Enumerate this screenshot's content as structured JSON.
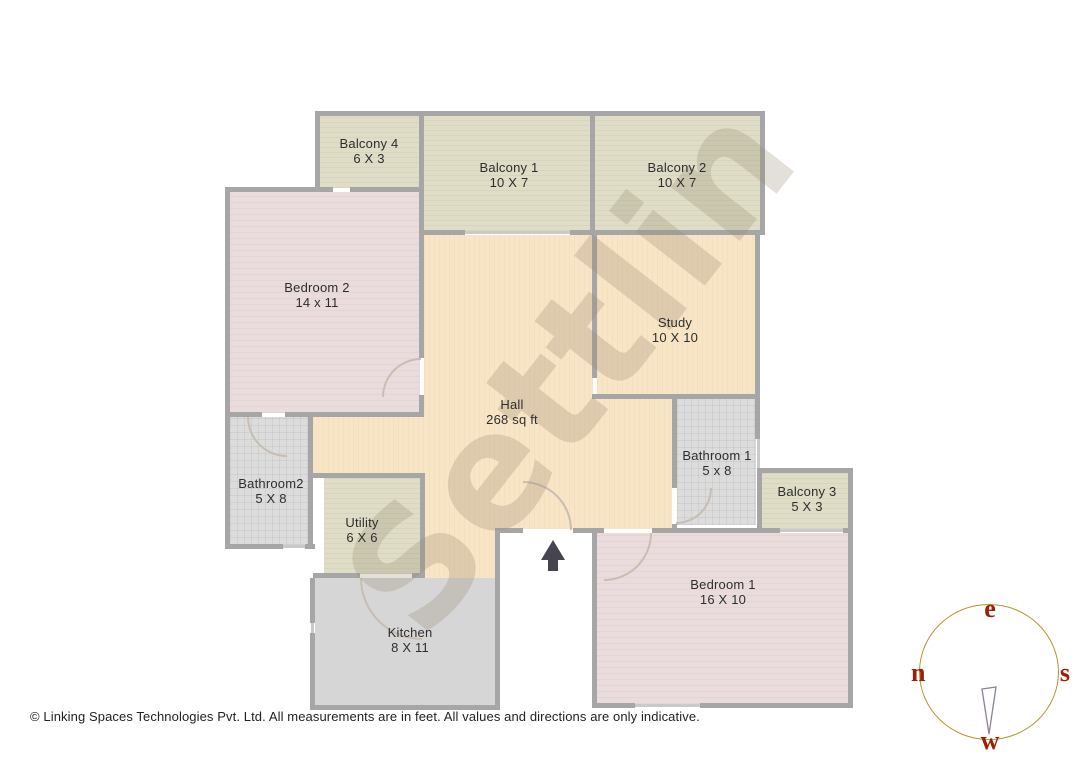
{
  "watermark": {
    "text": "Settlin"
  },
  "footer": {
    "text": "© Linking Spaces Technologies Pvt. Ltd. All measurements are in feet. All values and directions are only indicative."
  },
  "compass": {
    "east": "e",
    "north": "n",
    "south": "s",
    "west": "w",
    "circle_color": "#b8922e",
    "letter_color": "#9c1f06"
  },
  "colors": {
    "wall": "#a6a6a6",
    "window": "#c9c9c9",
    "door_arc": "#c7beb2",
    "balcony_fill": "#dfddc6",
    "hall_fill": "#f8e5c6",
    "bedroom_fill": "#eadcdc",
    "bathroom_fill": "#dcdcdc",
    "kitchen_fill": "#d6d6d6",
    "arrow": "#45444f"
  },
  "plan": {
    "rooms": [
      {
        "id": "balcony4",
        "type": "olive",
        "rects": [
          [
            320,
            116,
            100,
            72
          ]
        ],
        "label": {
          "name": "Balcony 4",
          "dims": "6 X 3",
          "cx": 369,
          "cy": 151
        }
      },
      {
        "id": "balcony1",
        "type": "olive",
        "rects": [
          [
            424,
            116,
            167,
            115
          ]
        ],
        "label": {
          "name": "Balcony 1",
          "dims": "10 X 7",
          "cx": 509,
          "cy": 175
        }
      },
      {
        "id": "balcony2",
        "type": "olive",
        "rects": [
          [
            595,
            116,
            166,
            115
          ]
        ],
        "label": {
          "name": "Balcony 2",
          "dims": "10 X 7",
          "cx": 677,
          "cy": 175
        }
      },
      {
        "id": "bedroom2",
        "type": "pink",
        "rects": [
          [
            230,
            192,
            190,
            221
          ]
        ],
        "label": {
          "name": "Bedroom 2",
          "dims": "14 x 11",
          "cx": 317,
          "cy": 295
        }
      },
      {
        "id": "study",
        "type": "peach",
        "rects": [
          [
            597,
            235,
            159,
            160
          ]
        ],
        "label": {
          "name": "Study",
          "dims": "10 X 10",
          "cx": 675,
          "cy": 330
        }
      },
      {
        "id": "hall",
        "type": "peach",
        "rects": [
          [
            424,
            235,
            169,
            162
          ],
          [
            424,
            395,
            248,
            134
          ],
          [
            313,
            414,
            112,
            61
          ],
          [
            424,
            474,
            72,
            105
          ]
        ],
        "label": {
          "name": "Hall",
          "dims": "268 sq ft",
          "cx": 512,
          "cy": 412
        }
      },
      {
        "id": "bathroom2",
        "type": "bath",
        "rects": [
          [
            230,
            417,
            79,
            128
          ]
        ],
        "label": {
          "name": "Bathroom2",
          "dims": "5 X 8",
          "cx": 271,
          "cy": 491
        }
      },
      {
        "id": "utility",
        "type": "olive",
        "rects": [
          [
            324,
            478,
            97,
            96
          ]
        ],
        "label": {
          "name": "Utility",
          "dims": "6 X 6",
          "cx": 362,
          "cy": 530
        }
      },
      {
        "id": "kitchen",
        "type": "kitchen",
        "rects": [
          [
            315,
            578,
            181,
            128
          ]
        ],
        "label": {
          "name": "Kitchen",
          "dims": "8 X 11",
          "cx": 410,
          "cy": 640
        }
      },
      {
        "id": "bathroom1",
        "type": "bath",
        "rects": [
          [
            677,
            399,
            79,
            126
          ]
        ],
        "label": {
          "name": "Bathroom 1",
          "dims": "5 x 8",
          "cx": 717,
          "cy": 463
        }
      },
      {
        "id": "balcony3",
        "type": "olive",
        "rects": [
          [
            762,
            473,
            87,
            56
          ]
        ],
        "label": {
          "name": "Balcony 3",
          "dims": "5 X 3",
          "cx": 807,
          "cy": 499
        }
      },
      {
        "id": "bedroom1",
        "type": "pink",
        "rects": [
          [
            597,
            533,
            252,
            171
          ]
        ],
        "label": {
          "name": "Bedroom 1",
          "dims": "16 X 10",
          "cx": 723,
          "cy": 592
        }
      }
    ],
    "walls": [
      [
        315,
        111,
        450,
        5
      ],
      [
        225,
        187,
        108,
        5
      ],
      [
        350,
        187,
        74,
        5
      ],
      [
        419,
        230,
        46,
        5
      ],
      [
        570,
        230,
        25,
        5
      ],
      [
        590,
        230,
        175,
        5
      ],
      [
        225,
        412,
        37,
        5
      ],
      [
        285,
        412,
        139,
        5
      ],
      [
        313,
        473,
        112,
        5
      ],
      [
        225,
        544,
        58,
        5
      ],
      [
        305,
        544,
        10,
        5
      ],
      [
        313,
        573,
        47,
        5
      ],
      [
        412,
        573,
        13,
        5
      ],
      [
        495,
        528,
        28,
        5
      ],
      [
        573,
        528,
        24,
        5
      ],
      [
        592,
        394,
        168,
        5
      ],
      [
        762,
        468,
        91,
        5
      ],
      [
        762,
        528,
        18,
        5
      ],
      [
        843,
        528,
        10,
        5
      ],
      [
        592,
        528,
        12,
        5
      ],
      [
        652,
        528,
        110,
        5
      ],
      [
        592,
        703,
        43,
        5
      ],
      [
        700,
        703,
        153,
        5
      ],
      [
        310,
        705,
        190,
        5
      ],
      [
        315,
        111,
        5,
        81
      ],
      [
        419,
        111,
        5,
        81
      ],
      [
        419,
        192,
        5,
        166
      ],
      [
        419,
        395,
        5,
        22
      ],
      [
        590,
        111,
        5,
        124
      ],
      [
        760,
        111,
        5,
        124
      ],
      [
        225,
        187,
        5,
        362
      ],
      [
        308,
        412,
        5,
        137
      ],
      [
        310,
        578,
        5,
        45
      ],
      [
        310,
        633,
        5,
        77
      ],
      [
        420,
        473,
        5,
        105
      ],
      [
        495,
        528,
        5,
        182
      ],
      [
        592,
        528,
        5,
        180
      ],
      [
        592,
        235,
        5,
        143
      ],
      [
        755,
        235,
        5,
        159
      ],
      [
        755,
        394,
        5,
        45
      ],
      [
        757,
        468,
        5,
        60
      ],
      [
        848,
        468,
        5,
        240
      ],
      [
        672,
        397,
        5,
        91
      ],
      [
        672,
        524,
        5,
        9
      ]
    ],
    "windows": [
      [
        465,
        231,
        105,
        3
      ],
      [
        780,
        529,
        63,
        3
      ],
      [
        635,
        704,
        65,
        3
      ],
      [
        757,
        439,
        3,
        29
      ],
      [
        311,
        623,
        3,
        10
      ],
      [
        283,
        545,
        22,
        3
      ]
    ],
    "doors": [
      {
        "x": 382,
        "y": 358,
        "w": 37,
        "h": 37,
        "corner": "tl"
      },
      {
        "x": 247,
        "y": 417,
        "w": 38,
        "h": 38,
        "corner": "bl"
      },
      {
        "x": 523,
        "y": 481,
        "w": 47,
        "h": 47,
        "corner": "tr"
      },
      {
        "x": 604,
        "y": 533,
        "w": 46,
        "h": 46,
        "corner": "br"
      },
      {
        "x": 676,
        "y": 488,
        "w": 34,
        "h": 34,
        "corner": "br"
      },
      {
        "x": 360,
        "y": 578,
        "w": 60,
        "h": 60,
        "corner": "bl"
      }
    ]
  }
}
